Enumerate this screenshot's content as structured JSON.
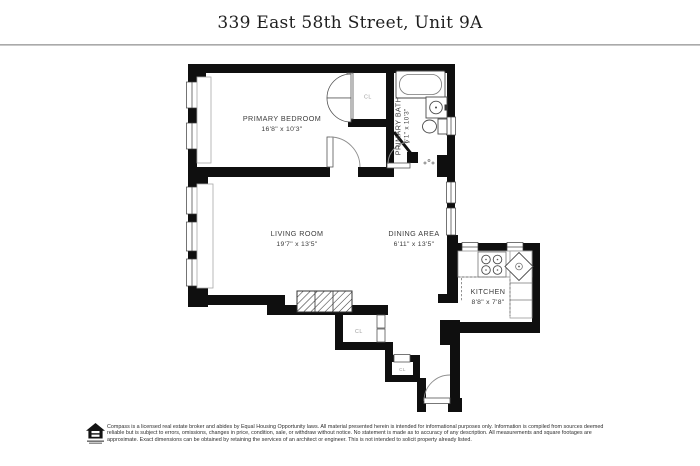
{
  "header": {
    "title": "339 East 58th Street, Unit 9A"
  },
  "floorplan": {
    "rooms": [
      {
        "id": "primary-bedroom",
        "name": "PRIMARY BEDROOM",
        "dims": "16'8\" x 10'3\""
      },
      {
        "id": "primary-bath",
        "name": "PRIMARY BATH",
        "dims": "6'1\" x 10'3\""
      },
      {
        "id": "living-room",
        "name": "LIVING ROOM",
        "dims": "19'7\" x 13'5\""
      },
      {
        "id": "dining-area",
        "name": "DINING AREA",
        "dims": "6'11\" x 13'5\""
      },
      {
        "id": "kitchen",
        "name": "KITCHEN",
        "dims": "8'8\" x 7'8\""
      }
    ],
    "closets": [
      {
        "id": "closet-bedroom",
        "label": "CL"
      },
      {
        "id": "closet-foyer-large",
        "label": "CL"
      },
      {
        "id": "closet-foyer-small",
        "label": "CL"
      }
    ]
  },
  "footer": {
    "disclaimer": "Compass is a licensed real estate broker and abides by Equal Housing Opportunity laws. All material presented herein is intended for informational purposes only. Information is compiled from sources deemed reliable but is subject to errors, omissions, changes in price, condition, sale, or withdraw without notice. No statement is made as to accuracy of any description. All measurements and square footages are approximate. Exact dimensions can be obtained by retaining the services of an architect or engineer. This is not intended to solicit property already listed."
  },
  "colors": {
    "wall": "#0f0f0f",
    "label": "#3b3b3b",
    "closet_label": "#9b9b9b",
    "rule": "#9a9a9a"
  }
}
